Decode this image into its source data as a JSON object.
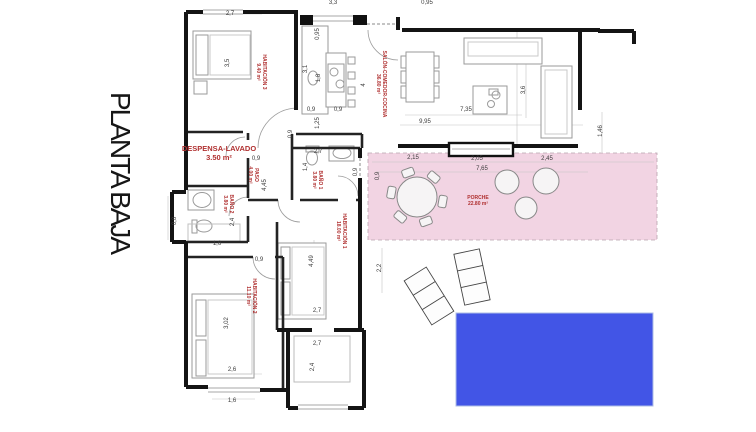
{
  "page_title": "PLANTA BAJA",
  "colors": {
    "pool": "#4255e6",
    "porch": "#f2d4e3",
    "label": "#b03030",
    "wall": "#181818",
    "dim": "#3c3c3c"
  },
  "rooms": [
    {
      "id": "habitacion-3",
      "name": "HABITACIÓN 3",
      "area": "9.40 m²",
      "x": 261,
      "y": 72,
      "rot": 90,
      "cls": "small"
    },
    {
      "id": "salon-comedor-cocina",
      "name": "SALÓN-COMEDOR-COCINA",
      "area": "36.80 m²",
      "x": 381,
      "y": 84,
      "rot": 90,
      "cls": "small"
    },
    {
      "id": "despensa-lavado",
      "name": "DESPENSA-LAVADO",
      "area": "3.50 m²",
      "x": 219,
      "y": 153,
      "rot": 0,
      "cls": "big"
    },
    {
      "id": "paso",
      "name": "PASO",
      "area": "4.00 m²",
      "x": 253,
      "y": 175,
      "rot": 90,
      "cls": "small"
    },
    {
      "id": "bano-1",
      "name": "BAÑO 1",
      "area": "3.80 m²",
      "x": 317,
      "y": 180,
      "rot": 90,
      "cls": "small"
    },
    {
      "id": "bano-2",
      "name": "BAÑO 2",
      "area": "3.80 m²",
      "x": 228,
      "y": 204,
      "rot": 90,
      "cls": "small"
    },
    {
      "id": "habitacion-1",
      "name": "HABITACIÓN 1",
      "area": "18.00 m²",
      "x": 341,
      "y": 231,
      "rot": 90,
      "cls": "small"
    },
    {
      "id": "habitacion-2",
      "name": "HABITACIÓN 2",
      "area": "11.10 m²",
      "x": 251,
      "y": 296,
      "rot": 90,
      "cls": "small"
    },
    {
      "id": "porche",
      "name": "PORCHE",
      "area": "22.80 m²",
      "x": 478,
      "y": 201,
      "rot": 0,
      "cls": "small"
    }
  ],
  "dimensions": [
    {
      "t": "2,7",
      "x": 230,
      "y": 14
    },
    {
      "t": "3,3",
      "x": 333,
      "y": 3
    },
    {
      "t": "0,95",
      "x": 427,
      "y": 3
    },
    {
      "t": "0,95",
      "x": 318,
      "y": 34,
      "v": 1
    },
    {
      "t": "3,5",
      "x": 228,
      "y": 63,
      "v": 1
    },
    {
      "t": "3,1",
      "x": 306,
      "y": 69,
      "v": 1
    },
    {
      "t": "1,8",
      "x": 319,
      "y": 78,
      "v": 1
    },
    {
      "t": "4",
      "x": 364,
      "y": 85,
      "v": 1
    },
    {
      "t": "0,9",
      "x": 311,
      "y": 110
    },
    {
      "t": "0,9",
      "x": 338,
      "y": 110
    },
    {
      "t": "1,25",
      "x": 318,
      "y": 123,
      "v": 1
    },
    {
      "t": "0,9",
      "x": 291,
      "y": 134,
      "v": 1
    },
    {
      "t": "7,35",
      "x": 466,
      "y": 110
    },
    {
      "t": "9,95",
      "x": 425,
      "y": 122
    },
    {
      "t": "3,6",
      "x": 524,
      "y": 90,
      "v": 1
    },
    {
      "t": "1,46",
      "x": 601,
      "y": 131,
      "v": 1
    },
    {
      "t": "2,15",
      "x": 413,
      "y": 158
    },
    {
      "t": "2,05",
      "x": 477,
      "y": 159
    },
    {
      "t": "2,45",
      "x": 547,
      "y": 159
    },
    {
      "t": "7,65",
      "x": 482,
      "y": 169
    },
    {
      "t": "0,9",
      "x": 378,
      "y": 176,
      "v": 1
    },
    {
      "t": "0,9",
      "x": 256,
      "y": 159
    },
    {
      "t": "4,45",
      "x": 265,
      "y": 185,
      "v": 1
    },
    {
      "t": "2,7",
      "x": 318,
      "y": 152
    },
    {
      "t": "1,4",
      "x": 306,
      "y": 167,
      "v": 1
    },
    {
      "t": "0,9",
      "x": 356,
      "y": 172,
      "v": 1
    },
    {
      "t": "0,8",
      "x": 175,
      "y": 221,
      "v": 1
    },
    {
      "t": "2,4",
      "x": 233,
      "y": 222,
      "v": 1
    },
    {
      "t": "1,6",
      "x": 217,
      "y": 244
    },
    {
      "t": "0,9",
      "x": 259,
      "y": 260
    },
    {
      "t": "4,49",
      "x": 312,
      "y": 261,
      "v": 1
    },
    {
      "t": "2,2",
      "x": 380,
      "y": 268,
      "v": 1
    },
    {
      "t": "3,02",
      "x": 227,
      "y": 323,
      "v": 1
    },
    {
      "t": "2,6",
      "x": 232,
      "y": 370
    },
    {
      "t": "2,7",
      "x": 317,
      "y": 311
    },
    {
      "t": "2,7",
      "x": 317,
      "y": 344
    },
    {
      "t": "2,4",
      "x": 313,
      "y": 367,
      "v": 1
    },
    {
      "t": "1,6",
      "x": 232,
      "y": 401
    }
  ]
}
